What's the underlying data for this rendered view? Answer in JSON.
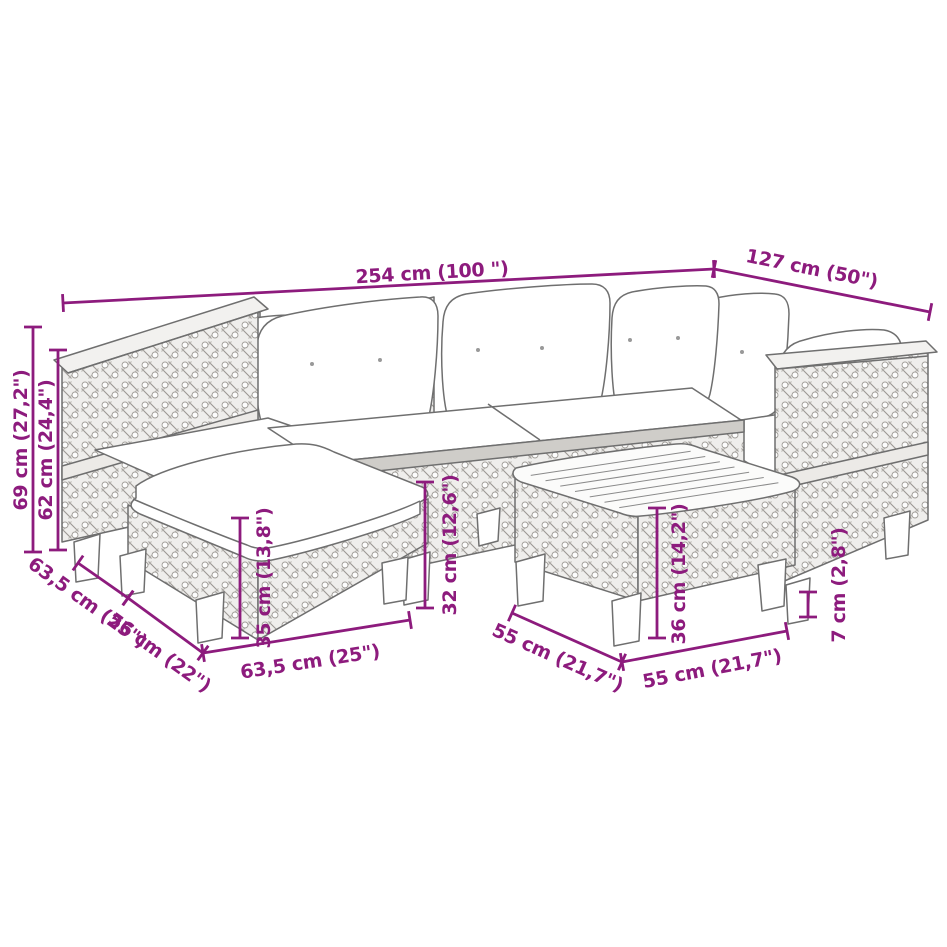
{
  "diagram": {
    "accent_color": "#8d1b7d",
    "line_color": "#6f6f6f",
    "background_color": "#ffffff",
    "dimensions": [
      {
        "name": "total-width",
        "label": "254 cm (100 \")"
      },
      {
        "name": "total-depth",
        "label": "127 cm (50\")"
      },
      {
        "name": "back-height",
        "label": "69 cm (27,2\")"
      },
      {
        "name": "armrest-height",
        "label": "62 cm (24,4\")"
      },
      {
        "name": "corner-depth",
        "label": "63,5 cm (25\")"
      },
      {
        "name": "seat-width",
        "label": "56 cm (22\")"
      },
      {
        "name": "ottoman-height",
        "label": "35 cm (13,8\")"
      },
      {
        "name": "ottoman-width",
        "label": "63,5 cm (25\")"
      },
      {
        "name": "seat-height",
        "label": "32 cm (12,6\")"
      },
      {
        "name": "table-height",
        "label": "36 cm (14,2\")"
      },
      {
        "name": "table-depth",
        "label": "55 cm (21,7\")"
      },
      {
        "name": "table-width",
        "label": "55 cm (21,7\")"
      },
      {
        "name": "small-height",
        "label": "7 cm (2,8\")"
      }
    ]
  }
}
